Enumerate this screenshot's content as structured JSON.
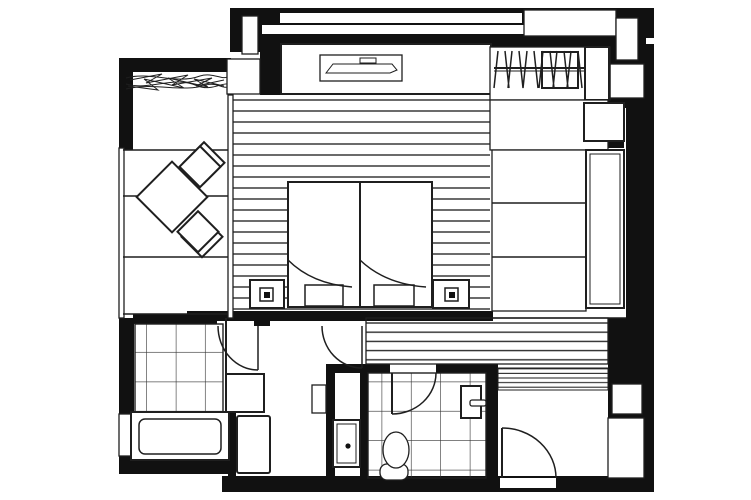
{
  "document": {
    "kind": "architectural-floor-plan",
    "appearance": "monochrome line drawing with solid black walls, no text labels"
  },
  "colors": {
    "wall": "#111111",
    "line": "#1f1f1f",
    "floor": "#ffffff",
    "stripe": "#2b2b2b"
  },
  "rooms": [
    {
      "name": "balcony",
      "items": [
        "planting-texture",
        "outdoor-table",
        "outdoor-chair-upper",
        "outdoor-chair-lower",
        "railing",
        "section-lines"
      ]
    },
    {
      "name": "bedroom",
      "items": [
        "tv-console",
        "tv",
        "bed-left",
        "bed-right",
        "pillow-left",
        "pillow-right",
        "blanket-fold-left",
        "blanket-fold-right",
        "nightstand-left",
        "nightstand-right",
        "lamp-left",
        "lamp-right",
        "striped-deck-floor",
        "window-band"
      ]
    },
    {
      "name": "closet",
      "items": [
        "hanger-rod",
        "hangers",
        "garment-group",
        "side-panel"
      ]
    },
    {
      "name": "storage-room",
      "items": [
        "cabinet-square"
      ]
    },
    {
      "name": "desk-counter",
      "items": [
        "long-counter",
        "shelf-sections"
      ]
    },
    {
      "name": "corridor",
      "items": [
        "wood-striped-floor"
      ]
    },
    {
      "name": "bathroom",
      "items": [
        "tile-floor",
        "bathtub",
        "door-swing",
        "step-square",
        "side-window"
      ]
    },
    {
      "name": "washroom",
      "items": [
        "vanity-square",
        "washing-machine",
        "wall-shelf",
        "door-swing"
      ]
    },
    {
      "name": "cabinet-compartment",
      "items": [
        "panel-door-with-knob"
      ]
    },
    {
      "name": "toilet-room",
      "items": [
        "tile-floor",
        "toilet",
        "door-swing",
        "wall-fixture"
      ]
    },
    {
      "name": "entry",
      "items": [
        "entrance-door-swing",
        "doormat-stripes",
        "threshold-gap",
        "service-boxes"
      ]
    }
  ]
}
